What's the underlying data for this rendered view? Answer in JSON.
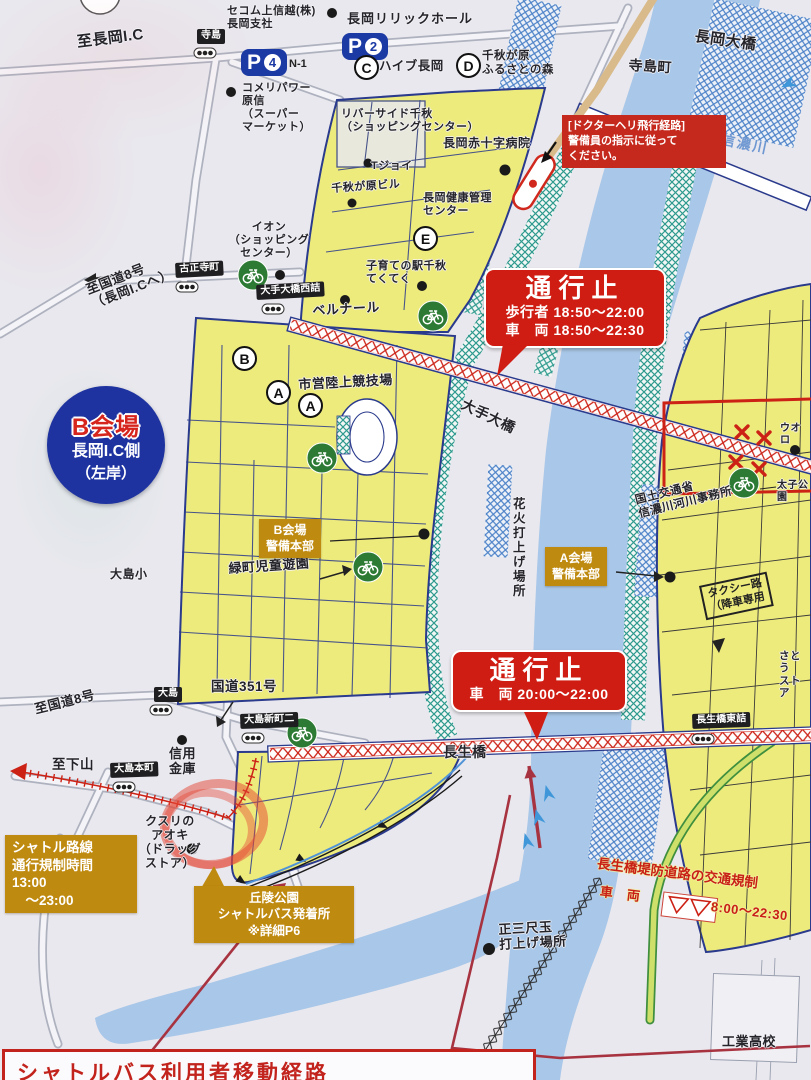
{
  "colors": {
    "paper": "#e9e8ee",
    "river": "#a9c7e8",
    "venue_yellow": "#eeeb7d",
    "teal_hatch": "#2f9a8e",
    "blue_hatch": "#4d82c8",
    "closure_red": "#cf1d13",
    "hq_orange": "#bf8a10",
    "badge_blue": "#1e33a0",
    "navy_road": "#2a3a8c",
    "route_darkred": "#a83340",
    "bike_green": "#2d7a35"
  },
  "icons": {
    "bicycle-parking": "bike in green circle",
    "traffic-signal": "three dots in pill",
    "poi-dot": "●",
    "closed-x": "×",
    "flow-arrow": "chevron",
    "helipad": "red capsule",
    "hand-drawn-circle": "red marker ellipse"
  },
  "area_badge": {
    "title": "B会場",
    "subtitle": "長岡I.C側",
    "subtitle2": "（左岸）"
  },
  "closures": [
    {
      "title": "通行止",
      "lines": "歩行者 18:50～22:00\n車　両 18:50～22:30"
    },
    {
      "title": "通行止",
      "lines": "車　両 20:00～22:00"
    }
  ],
  "heli_notice": {
    "text": "[ドクターヘリ飛行経路]\n警備員の指示に従って\nください。"
  },
  "hq_badges": [
    {
      "label": "B会場\n警備本部"
    },
    {
      "label": "A会場\n警備本部"
    }
  ],
  "shuttle_badges": [
    {
      "label": "シャトル路線\n通行規制時間\n13:00\n　～23:00"
    },
    {
      "label": "丘陵公園\nシャトルバス発着所\n※詳細P6"
    }
  ],
  "embankment_regulation": {
    "title": "長生橋堤防道路の交通規制",
    "vehicle": "車　両",
    "hours": "8:00～22:30"
  },
  "bottom_box": {
    "title": "シャトルバス利用者移動経路"
  },
  "parking": [
    {
      "letter": "P",
      "number": "4",
      "note": "N-1"
    },
    {
      "letter": "P",
      "number": "2",
      "note": ""
    }
  ],
  "signals": [
    {
      "label": "寺島"
    },
    {
      "label": "古正寺町"
    },
    {
      "label": "大手大橋西詰"
    },
    {
      "label": "大島"
    },
    {
      "label": "大島新町二"
    },
    {
      "label": "大島本町"
    },
    {
      "label": "長生橋東詰"
    }
  ],
  "stops": [
    {
      "letter": "C",
      "label": "ハイブ長岡"
    },
    {
      "letter": "D",
      "label": "千秋が原\nふるさとの森"
    },
    {
      "letter": "E",
      "label": ""
    },
    {
      "letter": "B",
      "label": ""
    },
    {
      "letter": "A",
      "label": ""
    },
    {
      "letter": "A",
      "label": ""
    }
  ],
  "places": [
    {
      "text": "至長岡I.C"
    },
    {
      "text": "セコム上信越(株)\n長岡支社"
    },
    {
      "text": "コメリパワー\n原信\n（スーパー\nマーケット）"
    },
    {
      "text": "長岡リリックホール"
    },
    {
      "text": "寺島町"
    },
    {
      "text": "長岡大橋"
    },
    {
      "text": "信濃川"
    },
    {
      "text": "リバーサイド千秋\n（ショッピングセンター）"
    },
    {
      "text": "長岡赤十字病院"
    },
    {
      "text": "Tジョイ"
    },
    {
      "text": "千秋が原ビル"
    },
    {
      "text": "長岡健康管理\nセンター"
    },
    {
      "text": "イオン\n（ショッピング\nセンター）"
    },
    {
      "text": "子育ての駅千秋\nてくてく"
    },
    {
      "text": "ベルナール"
    },
    {
      "text": "至国道8号\n（長岡I.Cへ）"
    },
    {
      "text": "市営陸上競技場"
    },
    {
      "text": "大手大橋"
    },
    {
      "text": "花火打上げ場所"
    },
    {
      "text": "緑町児童遊園"
    },
    {
      "text": "大島小"
    },
    {
      "text": "国土交通省\n信濃川河川事務所"
    },
    {
      "text": "タクシー路\n（降車専用"
    },
    {
      "text": "太子公園"
    },
    {
      "text": "ウオロ"
    },
    {
      "text": "国道351号"
    },
    {
      "text": "信用\n金庫"
    },
    {
      "text": "至国道8号"
    },
    {
      "text": "至下山"
    },
    {
      "text": "クスリの\nアオキ\n（ドラッグ\nストア）"
    },
    {
      "text": "正三尺玉\n打上げ場所"
    },
    {
      "text": "長生橋"
    },
    {
      "text": "さとう\nストア"
    },
    {
      "text": "大宮町"
    },
    {
      "text": "工業高校"
    }
  ]
}
